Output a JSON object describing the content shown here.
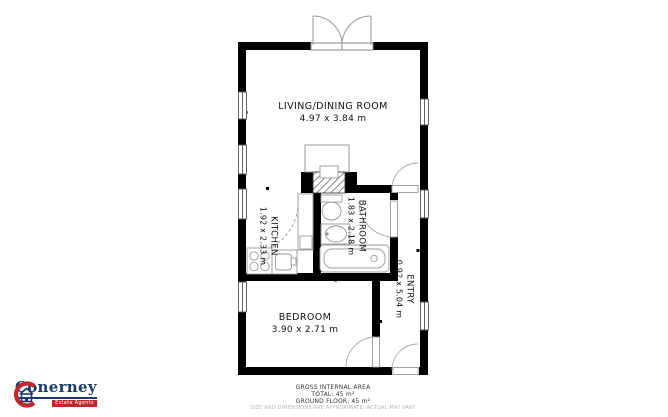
{
  "plan": {
    "rooms": [
      {
        "name": "LIVING/DINING ROOM",
        "dims": "4.97 x 3.84 m"
      },
      {
        "name": "KITCHEN",
        "dims": "1.92 x 2.33 m"
      },
      {
        "name": "BATHROOM",
        "dims": "1.83 x 2.18 m"
      },
      {
        "name": "ENTRY",
        "dims": "0.92 x 5.04 m"
      },
      {
        "name": "BEDROOM",
        "dims": "3.90 x 2.71 m"
      }
    ],
    "fixtures": [
      "french-doors-icon",
      "door-swing-icon",
      "window-icon",
      "chimney-hatch-icon",
      "stove-icon",
      "kitchen-sink-icon",
      "counter-icon",
      "toilet-icon",
      "washbasin-icon",
      "bathtub-icon"
    ]
  },
  "footer": {
    "line1": "GROSS INTERNAL AREA",
    "line2": "TOTAL: 45 m²",
    "line3": "GROUND FLOOR: 45 m²",
    "disclaimer": "SIZE AND DIMENSIONS ARE APPROXIMATE, ACTUAL MAY VARY"
  },
  "logo": {
    "name": "Conerney",
    "tagline": "Estate Agents"
  },
  "colors": {
    "wall": "#000000",
    "fixture_line": "#999999",
    "label_text": "#111111",
    "logo_navy": "#1b3a6b",
    "logo_red": "#c1272d",
    "disclaimer_gray": "#b5b5b5"
  }
}
